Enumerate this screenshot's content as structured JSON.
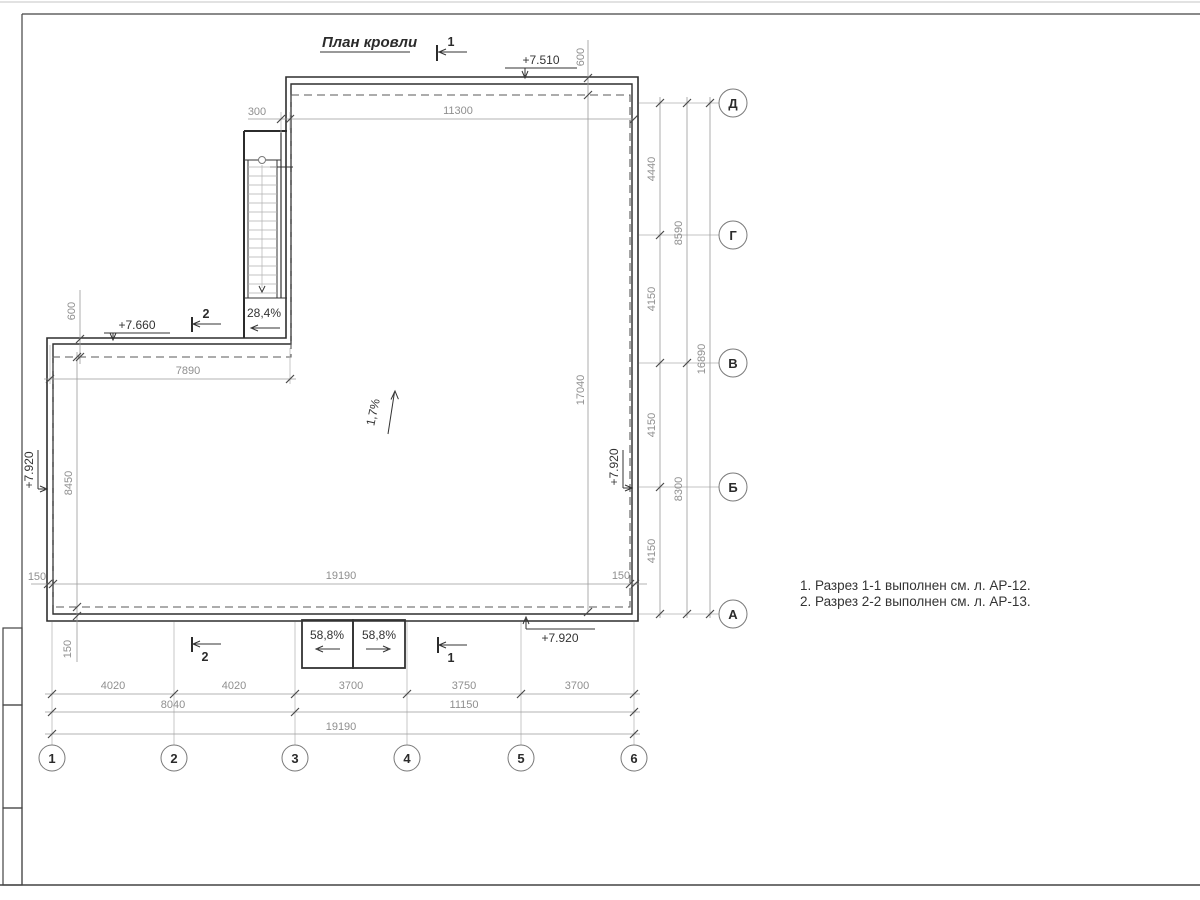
{
  "title": "План кровли",
  "notes": {
    "n1": "1. Разрез 1-1 выполнен см. л. АР-12.",
    "n2": "2. Разрез 2-2 выполнен см. л. АР-13."
  },
  "axes": {
    "rows": {
      "d": "Д",
      "g": "Г",
      "v": "В",
      "b": "Б",
      "a": "А"
    },
    "cols": {
      "c1": "1",
      "c2": "2",
      "c3": "3",
      "c4": "4",
      "c5": "5",
      "c6": "6"
    }
  },
  "elevations": {
    "top": "+7.510",
    "wing": "+7.660",
    "left": "+7.920",
    "right": "+7.920",
    "bottom": "+7.920"
  },
  "slopes": {
    "stair": "28,4%",
    "roof": "1,7%",
    "canopy_left": "58,8%",
    "canopy_right": "58,8%"
  },
  "section_marks": {
    "top": "1",
    "wing": "2",
    "bottom_left": "2",
    "bottom_right": "1"
  },
  "dims": {
    "d300": "300",
    "d11300": "11300",
    "d600_top": "600",
    "d600_wing": "600",
    "d7890": "7890",
    "d8450": "8450",
    "d17040": "17040",
    "d150_left": "150",
    "d150_left_bottom": "150",
    "d150_right": "150",
    "d19190_inner": "19190",
    "d4440": "4440",
    "d4150_gv": "4150",
    "d4150_vb": "4150",
    "d4150_ba": "4150",
    "d8590": "8590",
    "d8300": "8300",
    "d16890": "16890",
    "r1_12": "4020",
    "r1_23": "4020",
    "r1_34": "3700",
    "r1_45": "3750",
    "r1_56": "3700",
    "r2_13": "8040",
    "r2_36": "11150",
    "r3_16": "19190"
  },
  "colors": {
    "line_dark": "#2f2f2f",
    "line_dim": "#9a9a9a",
    "text_dim": "#8f8f8f",
    "text_dark": "#333333"
  }
}
